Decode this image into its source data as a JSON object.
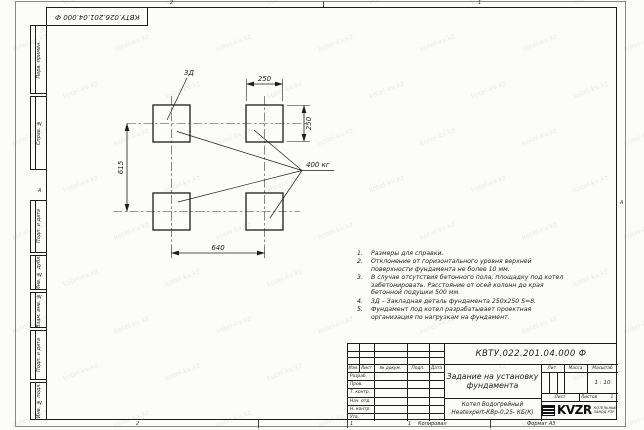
{
  "page": {
    "top_stamp": "КВТУ.026.201.04.000 Ф",
    "zone_top_left": "2",
    "zone_top_right": "1",
    "zone_bottom_left": "2",
    "zone_bottom_right": "1",
    "zone_row_left": "А",
    "zone_row_right": "А",
    "bottom_sheet_num": "1",
    "copied_label": "Копировал",
    "format_label": "Формат А3"
  },
  "watermark": {
    "text": "kotel-kv.kz"
  },
  "margin_boxes": [
    "Перв. примен.",
    "Справ. №",
    "Подп. и дата",
    "Инв. № дубл.",
    "Взам. инв. №",
    "Подп. и дата",
    "Инв. № подл."
  ],
  "drawing": {
    "zd_label": "3Д",
    "load_label": "400 кг",
    "dim_top": "250",
    "dim_right": "250",
    "dim_left": "615",
    "dim_bottom": "640"
  },
  "notes": [
    {
      "num": "1.",
      "text": "Размеры для справки."
    },
    {
      "num": "2.",
      "text": "Отклонение от горизонтального уровня верхней поверхности фундамента не более 10 мм."
    },
    {
      "num": "3.",
      "text": "В случае отсутствия бетонного пола, площадку под котел забетонировать. Расстояние от осей колонн до края бетонной подушки 500 мм."
    },
    {
      "num": "4.",
      "text": "3Д – Закладная деталь фундамента 250x250 S=8."
    },
    {
      "num": "5.",
      "text": "Фундамент под котел разрабатывает проектная организация по нагрузкам на фундамент."
    }
  ],
  "title_block": {
    "doc_number": "КВТУ.022.201.04.000 Ф",
    "title_line1": "Задание на установку",
    "title_line2": "фундамента",
    "product_line1": "Котел Водогрейный",
    "product_line2": "Heatexpert-КВр-0,25- КБ(К)",
    "header_cols": [
      "Изм.",
      "Лист",
      "№ докум.",
      "Подп.",
      "Дата"
    ],
    "rows": [
      "Разраб.",
      "Пров.",
      "Т. контр.",
      "Нач. отд.",
      "Н. контр.",
      "Утв."
    ],
    "lit_label": "Лит.",
    "mass_label": "Масса",
    "scale_label": "Масштаб",
    "scale_value": "1 : 10",
    "sheet_label": "Лист",
    "sheets_label": "Листов",
    "sheets_value": "1",
    "logo_text": "KVZR",
    "logo_sub1": "КОТЕЛЬНЫЙ",
    "logo_sub2": "ЗАВОД РЗР"
  }
}
